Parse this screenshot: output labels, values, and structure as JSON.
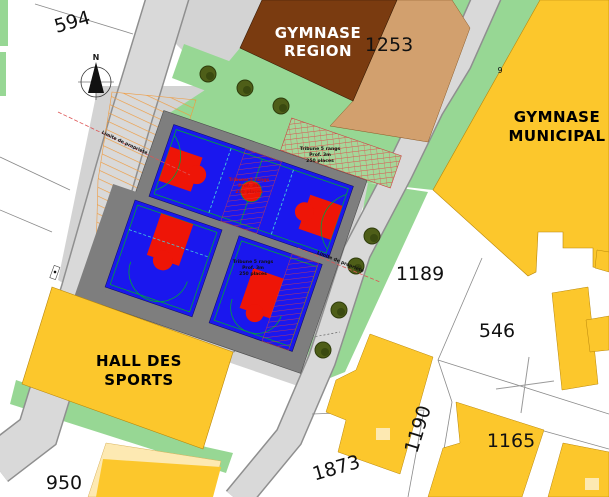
{
  "map": {
    "north_label": "N",
    "parcel_labels": {
      "p594": "594",
      "p950": "950",
      "p1253": "1253",
      "p1189": "1189",
      "p546": "546",
      "p1190": "1190",
      "p1165": "1165",
      "p1873": "1873",
      "p9": "9"
    },
    "buildings": {
      "gymnase_region": {
        "line1": "GYMNASE",
        "line2": "REGION"
      },
      "gymnase_municipal": {
        "line1": "GYMNASE",
        "line2": "MUNICIPAL"
      },
      "hall_des_sports": {
        "line1": "HALL DES",
        "line2": "SPORTS"
      }
    },
    "tribunes": {
      "top": {
        "line1": "Tribune 5 rangs",
        "line2": "Prof. 3m",
        "line3": "250 places"
      },
      "center": {
        "line1": "Tribune 5 rangs",
        "line2": "Prof. 3m",
        "line3": "250 places"
      },
      "bottom": {
        "line1": "Tribune 5 rangs",
        "line2": "Prof. 3m",
        "line3": "250 places"
      }
    },
    "boundary_notes": {
      "left": "Limite de propriété",
      "right": "Limite de propriété"
    },
    "colors": {
      "road": "#d9d9d9",
      "road_edge": "#8f8f8f",
      "plaza": "#d3d3d3",
      "green": "#97d794",
      "court_blue": "#1a17ee",
      "court_red": "#ee1507",
      "marking_green": "#00a23c",
      "dash_cyan": "#45c8dc",
      "frame_gray": "#7e7e7e",
      "building_brown": "#7a3b10",
      "building_tan": "#d2a06e",
      "cadastral_yellow": "#fcc72c",
      "pale_yellow": "#fde9b2",
      "tree_green": "#4e5e18",
      "hatch_orange": "#ef9b40",
      "hatch_red": "#e04040",
      "limit_red": "#dd5555"
    }
  }
}
